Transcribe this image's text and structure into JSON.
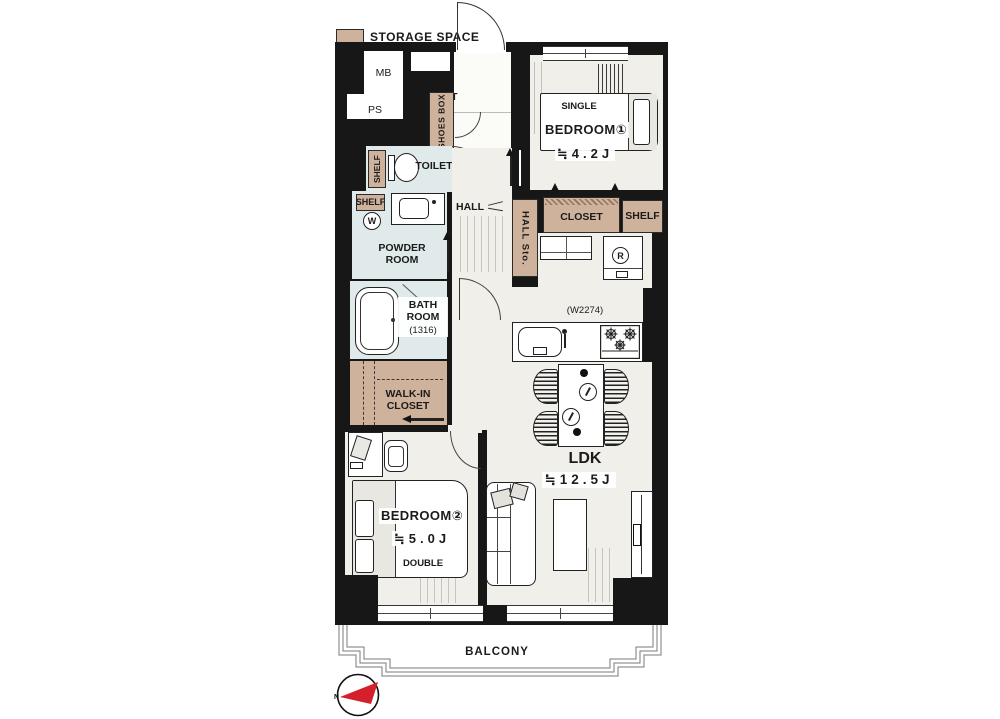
{
  "legend": {
    "label": "STORAGE SPACE"
  },
  "colors": {
    "wall": "#171717",
    "floor": "#f0efe9",
    "wet": "#e0eaea",
    "storage": "#cfb29c",
    "red": "#d3202a"
  },
  "shaft": {
    "mb": "MB",
    "ps": "PS"
  },
  "entrance": {
    "label": "ENT",
    "shoes_box": "SHOES BOX"
  },
  "toilet": {
    "label": "TOILET",
    "shelf": "SHELF"
  },
  "powder_room": {
    "label": "POWDER ROOM",
    "shelf": "SHELF",
    "washer": "W"
  },
  "bath_room": {
    "label": "BATH ROOM",
    "size": "(1316)"
  },
  "walk_in_closet": {
    "label": "WALK-IN CLOSET"
  },
  "hall": {
    "label": "HALL",
    "storage": "HALL Sto."
  },
  "bedroom1": {
    "name": "BEDROOM①",
    "size": "≒4.2J",
    "bed": "SINGLE",
    "closet": "CLOSET",
    "shelf": "SHELF"
  },
  "bedroom2": {
    "name": "BEDROOM②",
    "size": "≒5.0J",
    "bed": "DOUBLE"
  },
  "ldk": {
    "name": "LDK",
    "size": "≒12.5J",
    "kitchen_width": "(W2274)",
    "fridge": "R"
  },
  "balcony": {
    "label": "BALCONY"
  },
  "compass": {
    "north": "N"
  }
}
